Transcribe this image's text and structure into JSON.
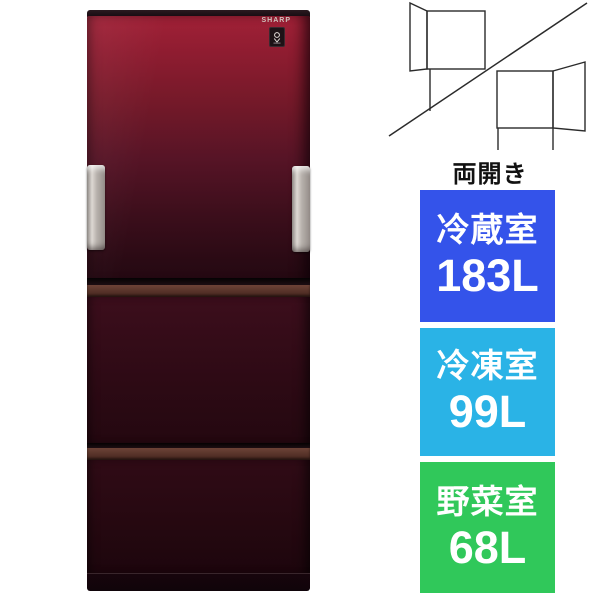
{
  "product_image": {
    "brand_logo": "SHARP",
    "plasmacluster_icon": "plasmacluster-icon"
  },
  "door_diagram": {
    "label": "両開き"
  },
  "capacity_badges": [
    {
      "name": "冷蔵室",
      "capacity": "183L",
      "color": "#3453ea"
    },
    {
      "name": "冷凍室",
      "capacity": "99L",
      "color": "#2ab3e6"
    },
    {
      "name": "野菜室",
      "capacity": "68L",
      "color": "#30c85a"
    }
  ],
  "colors": {
    "fridge_red_top": "#a12137",
    "fridge_red_bottom": "#220811",
    "handle_silver": "#c9c2bc",
    "drawer_handle_brown": "#5a352b",
    "diagram_line": "#2b2b2b",
    "badge_text": "#ffffff"
  }
}
